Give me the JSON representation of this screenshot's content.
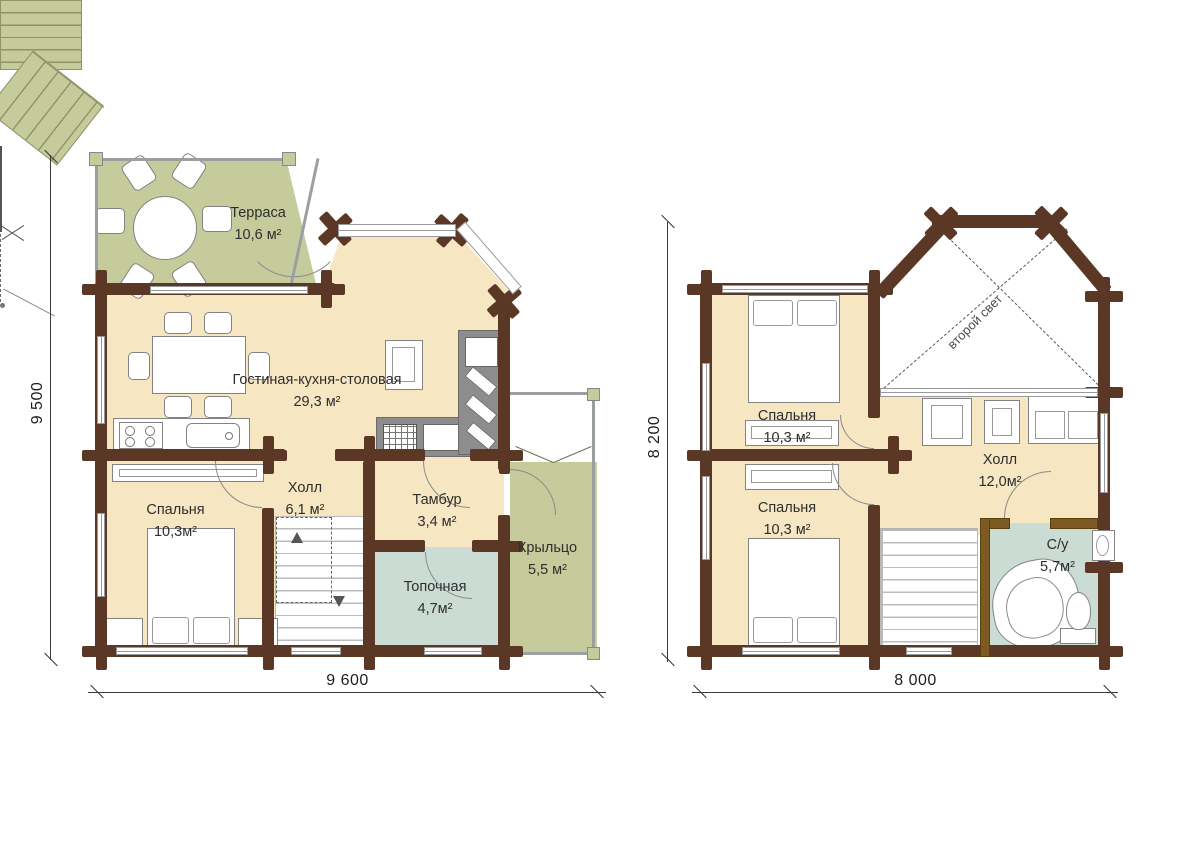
{
  "colors": {
    "wall_log": "#5b3726",
    "floor_beige": "#f6e6c1",
    "terrace_green": "#c6cb9b",
    "wet_room_teal": "#cbdcd4",
    "bath_partition_wood": "#7c5a22"
  },
  "plans": [
    {
      "id": "first-floor",
      "rooms": [
        {
          "id": "terrace",
          "label": "Терраса",
          "area": "10,6 м²"
        },
        {
          "id": "living",
          "label": "Гостиная-кухня-столовая",
          "area": "29,3 м²"
        },
        {
          "id": "bedroom",
          "label": "Спальня",
          "area": "10,3м²"
        },
        {
          "id": "hall",
          "label": "Холл",
          "area": "6,1 м²"
        },
        {
          "id": "tambour",
          "label": "Тамбур",
          "area": "3,4 м²"
        },
        {
          "id": "boiler",
          "label": "Топочная",
          "area": "4,7м²"
        },
        {
          "id": "porch",
          "label": "Крыльцо",
          "area": "5,5 м²"
        }
      ],
      "dim_width": "9 600",
      "dim_height": "9 500"
    },
    {
      "id": "second-floor",
      "rooms": [
        {
          "id": "bedroom-1",
          "label": "Спальня",
          "area": "10,3 м²"
        },
        {
          "id": "bedroom-2",
          "label": "Спальня",
          "area": "10,3 м²"
        },
        {
          "id": "hall",
          "label": "Холл",
          "area": "12,0м²"
        },
        {
          "id": "bathroom",
          "label": "С/у",
          "area": "5,7м²"
        },
        {
          "id": "void",
          "label": "второй свет",
          "area": ""
        }
      ],
      "dim_width": "8 000",
      "dim_height": "8 200"
    }
  ]
}
